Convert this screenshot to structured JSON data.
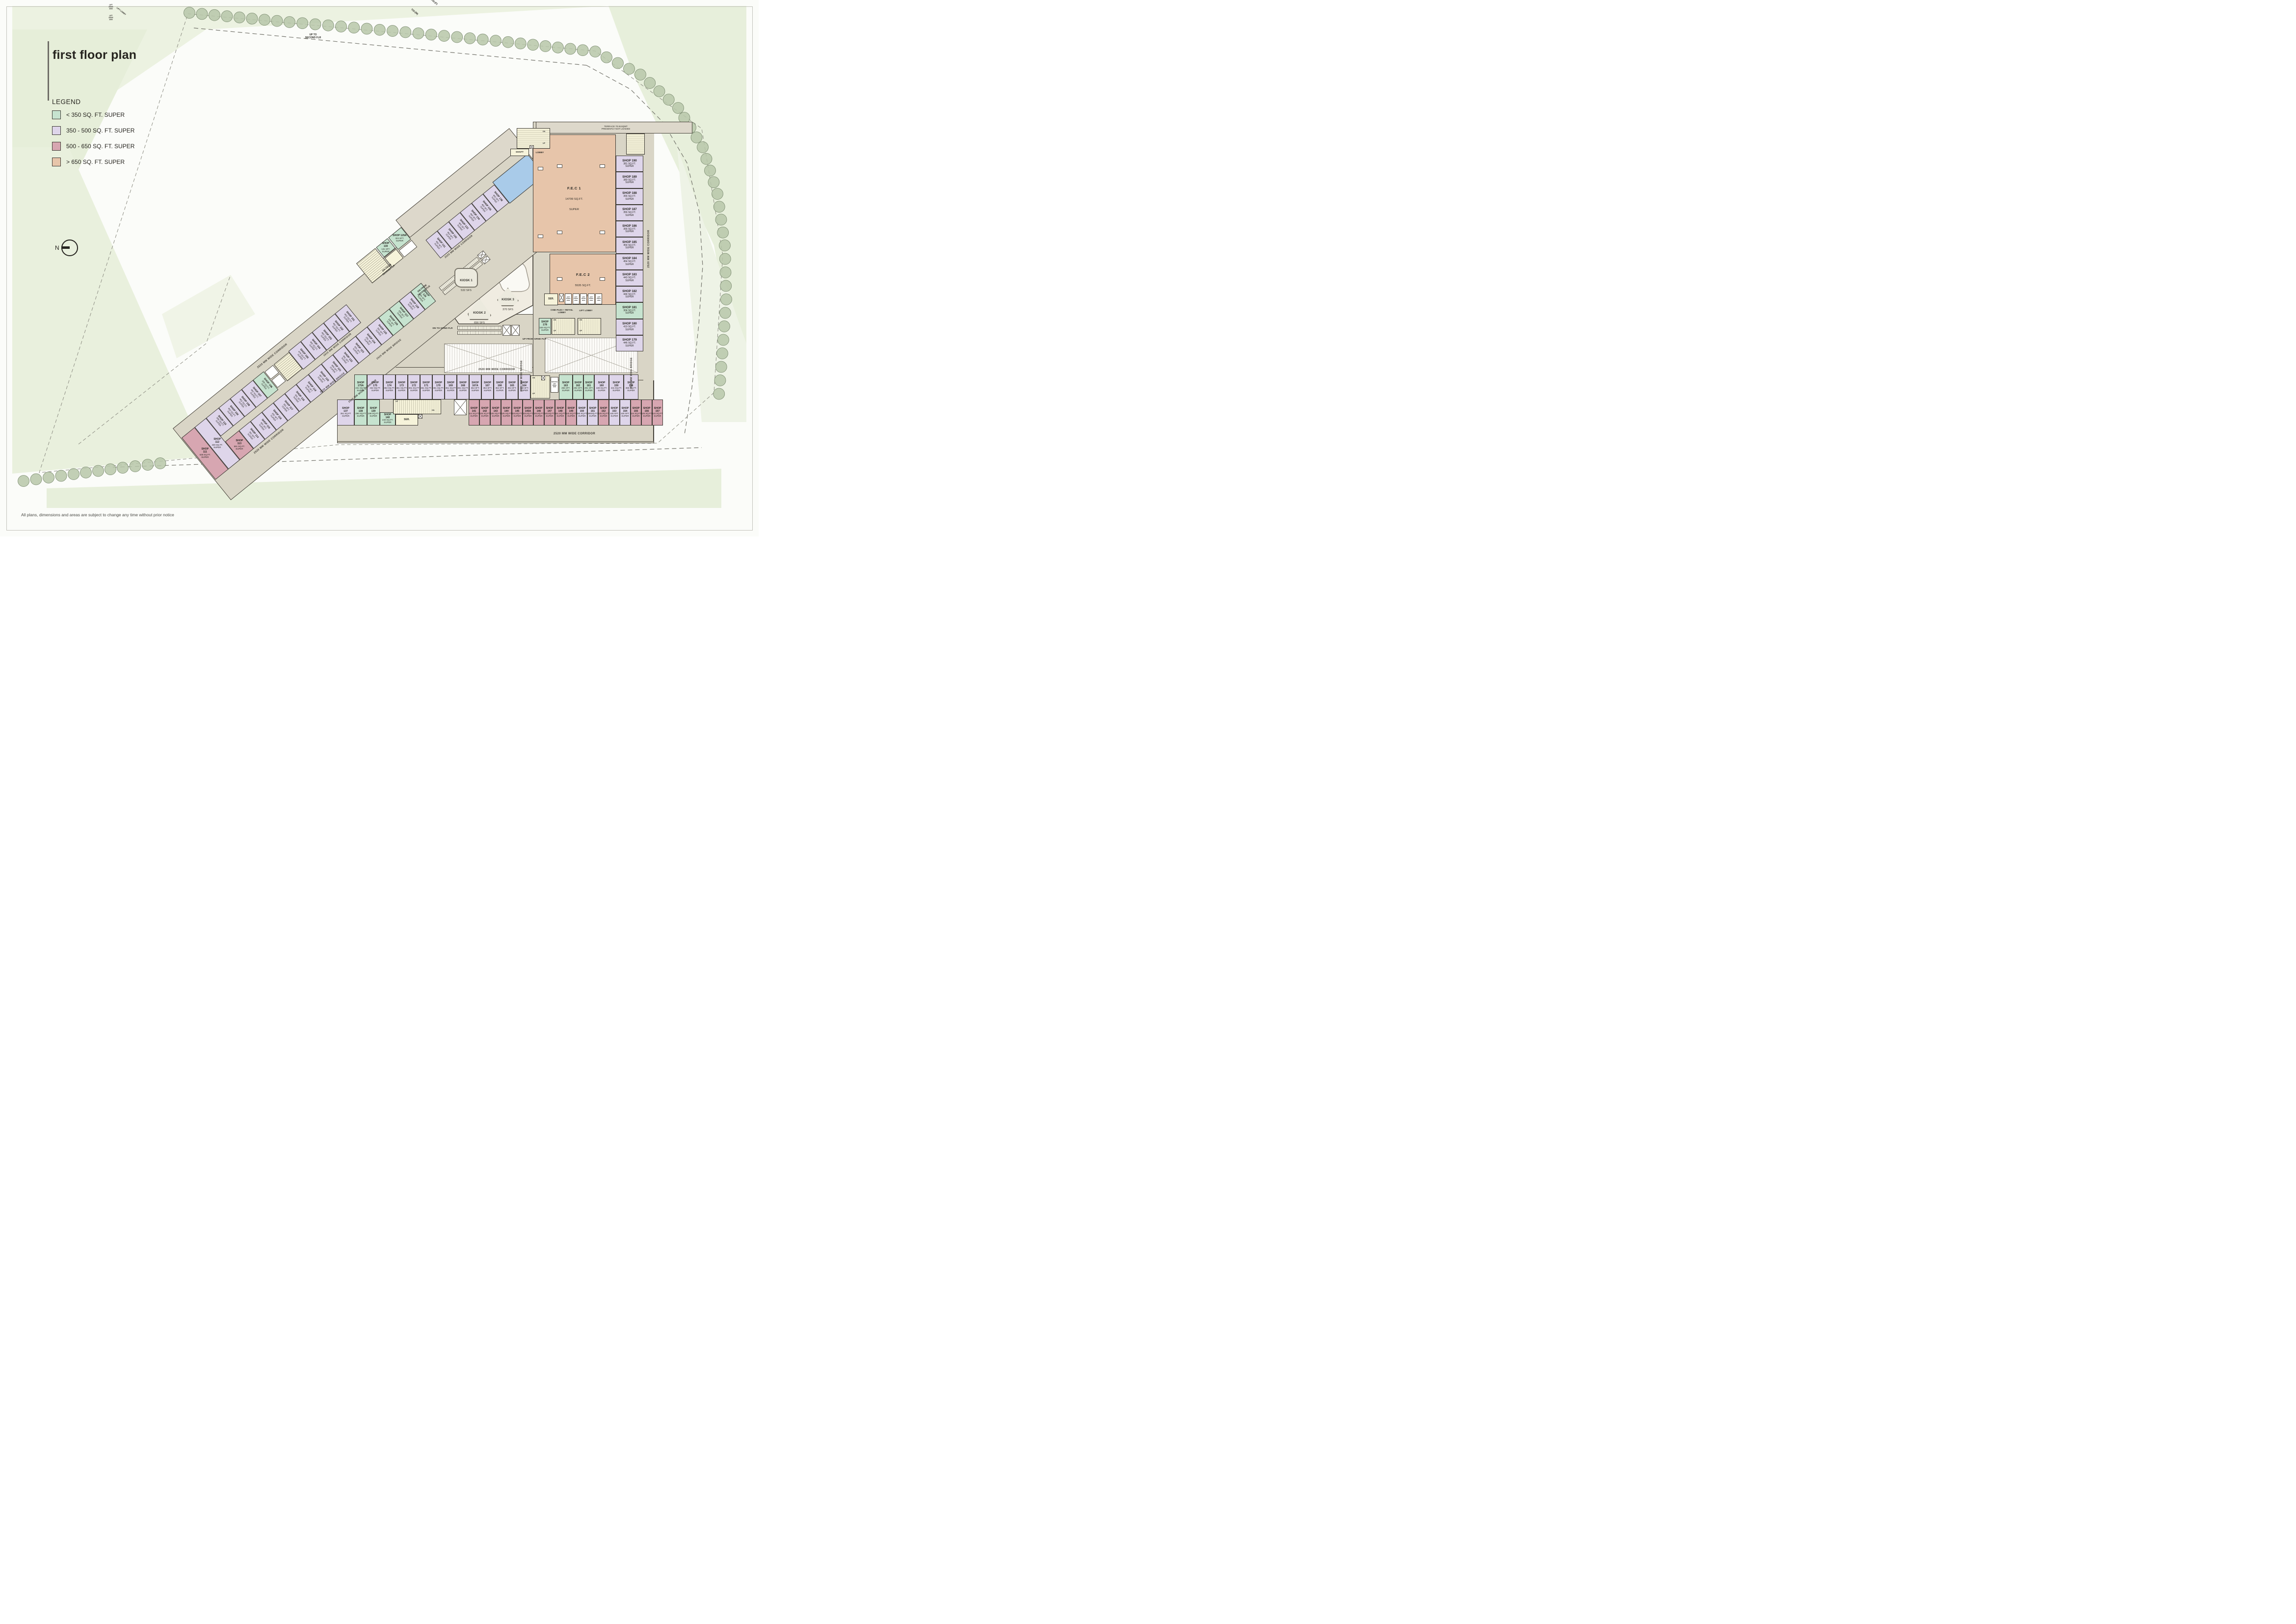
{
  "title": "first floor plan",
  "legend": {
    "heading": "LEGEND",
    "items": [
      {
        "label": "< 350 SQ. FT. SUPER",
        "color": "#c6e3cf"
      },
      {
        "label": "350 - 500 SQ. FT. SUPER",
        "color": "#ded5ea"
      },
      {
        "label": "500 - 650 SQ. FT. SUPER",
        "color": "#d7a6b1"
      },
      {
        "label": "> 650 SQ. FT. SUPER",
        "color": "#e7c5aa"
      }
    ]
  },
  "north_label": "N",
  "disclaimer": "All plans, dimensions and areas are subject to change any time without prior notice",
  "labels": {
    "super": "SUPER",
    "corridor_2520": "2520 MM WIDE CORRIDOR",
    "corridor_1915": "1915 MM WIDE CORRIDOR",
    "bridge_2520": "2520 MM WIDE BRIDGE",
    "terrace_top": "TERRACE 70.91SQMT\nPRESENTLY NOT LOADED",
    "terrace_wing": "TERRACE  277.6 SQMT\nPRESENTLY NOT LOADED"
  },
  "areas": {
    "fec1": {
      "name": "F.E.C 1",
      "area": "14799 SQ.FT.",
      "super": "SUPER"
    },
    "fec2": {
      "name": "F.E.C 2",
      "area": "5535 SQ.FT.",
      "super": "SUPER"
    },
    "kiosks": [
      {
        "name": "KIOSK 1",
        "area": "532 SFS"
      },
      {
        "name": "KIOSK 2",
        "area": "656 SFS"
      },
      {
        "name": "KIOSK 3",
        "area": "370 SFS"
      }
    ]
  },
  "rooms": {
    "toi_m": "TOI.(M)",
    "toi_f": "TOI.(F)",
    "shaft": "SHAFT",
    "lobby": "LOBBY",
    "ser": "SER.",
    "fhc": "FHC",
    "lift_lobby": "LIFT LOBBY",
    "cineplex": "CINE-PLEX + RETAIL\nLOBBY",
    "service_lift": "SERVICE LIFT\n3000X\n1800",
    "lift_2500": "LIFT\n2500X\n2000",
    "lift_2000": "LIFT\n2000X\n2500",
    "lift_3000": "LIFT\n3000X1800"
  },
  "circulation": {
    "up": "UP",
    "dn": "DN",
    "up_to_second": "UP TO\nSECOND FLR",
    "dn_from_second": "DN FROM\nSECOND FLR",
    "dn_to_grnd": "DN TO GRND FLR",
    "up_from_grnd": "UP FROM GRND  FLR"
  },
  "shops": {
    "wing_nw": [
      {
        "id": "SHOP  110",
        "area": "480 SQ.FT."
      },
      {
        "id": "SHOP  109",
        "area": "462 SQ.FT."
      },
      {
        "id": "SHOP  108",
        "area": "462 SQ.FT."
      },
      {
        "id": "SHOP  107",
        "area": "462 SQ.FT."
      },
      {
        "id": "SHOP  106",
        "area": "286 SQ.FT."
      },
      {
        "id": "SHOP  105",
        "area": "478 SQ.FT."
      },
      {
        "id": "SHOP  104",
        "area": "462 SQ.FT."
      },
      {
        "id": "SHOP  103",
        "area": "462 SQ.FT."
      },
      {
        "id": "SHOP  102",
        "area": "462 SQ.FT."
      },
      {
        "id": "SHOP  101",
        "area": "462 SQ.FT."
      }
    ],
    "wing_tip": [
      {
        "id": "SHOP\n111",
        "area": "638 SQ.FT."
      },
      {
        "id": "SHOP\n112",
        "area": "430 SQ.FT."
      },
      {
        "id": "SHOP\n113",
        "area": "591 SQ.FT."
      }
    ],
    "wing_se": [
      {
        "id": "SHOP  114",
        "area": "391 SFT."
      },
      {
        "id": "SHOP  115",
        "area": "391 SFT."
      },
      {
        "id": "SHOP  116",
        "area": "391 SFT."
      },
      {
        "id": "SHOP  117",
        "area": "391 SFT."
      },
      {
        "id": "SHOP  118",
        "area": "391 SFT."
      },
      {
        "id": "SHOP  119",
        "area": "445 SFT."
      },
      {
        "id": "SHOP  120",
        "area": "487 SFT."
      },
      {
        "id": "SHOP  121",
        "area": "404 SFT."
      },
      {
        "id": "SHOP  122",
        "area": "391 SFT."
      },
      {
        "id": "SHOP  123",
        "area": "391 SFT."
      },
      {
        "id": "SHOP  124",
        "area": "391 SFT."
      },
      {
        "id": "SHOP  125",
        "area": "391 SFT."
      },
      {
        "id": "SHOP  126",
        "area": "331 SFT."
      },
      {
        "id": "SHOP 127",
        "area": "284 SFT."
      },
      {
        "id": "SHOP 128",
        "area": "430 SFT."
      },
      {
        "id": "SHOP\n129",
        "area": "304 SFT."
      }
    ],
    "wing_top": [
      {
        "id": "SHOP  131",
        "area": "462 SFT."
      },
      {
        "id": "SHOP  132",
        "area": "462 SFT."
      },
      {
        "id": "SHOP  133",
        "area": "462 SFT."
      },
      {
        "id": "SHOP  134",
        "area": "462 SFT."
      },
      {
        "id": "SHOP  135",
        "area": "462 SFT."
      },
      {
        "id": "SHOP  136",
        "area": "462 SFT."
      }
    ],
    "wing_aux": [
      {
        "id": "SHOP\n130",
        "area": "131 SFT."
      },
      {
        "id": "SHOP 129A",
        "area": "324 SFT."
      }
    ],
    "right_col": [
      {
        "id": "SHOP  190",
        "area": "381 SQ.FT."
      },
      {
        "id": "SHOP  189",
        "area": "380 SQ.FT."
      },
      {
        "id": "SHOP  188",
        "area": "356 SQ.FT."
      },
      {
        "id": "SHOP  187",
        "area": "356 SQ.FT."
      },
      {
        "id": "SHOP  186",
        "area": "356 SQ.FT."
      },
      {
        "id": "SHOP  185",
        "area": "454 SQ.FT."
      },
      {
        "id": "SHOP  184",
        "area": "454 SQ.FT."
      },
      {
        "id": "SHOP 183",
        "area": "443 SQ.FT."
      },
      {
        "id": "SHOP 182",
        "area": "444 SQ.FT."
      },
      {
        "id": "SHOP 181",
        "area": "304 SQ.FT."
      },
      {
        "id": "SHOP 180",
        "area": "419 SQ.FT."
      },
      {
        "id": "SHOP 179",
        "area": "446 SQ.FT."
      }
    ],
    "right_mid": [
      {
        "id": "SHOP  178",
        "area": "349 SQ.FT."
      }
    ],
    "bottom_top": [
      {
        "id": "SHOP\n174",
        "area": "353 SQ.FT."
      },
      {
        "id": "SHOP\n173",
        "area": "361 SQ.FT."
      },
      {
        "id": "SHOP\n172",
        "area": "361 SQ.FT"
      },
      {
        "id": "SHOP\n171",
        "area": "361 SQ.FT."
      },
      {
        "id": "SHOP\n170",
        "area": "361 SQ.FT."
      },
      {
        "id": "SHOP\n169",
        "area": "361 SQ.FT"
      },
      {
        "id": "SHOP\n168",
        "area": "361 SQ.FT."
      },
      {
        "id": "SHOP\n167A",
        "area": "364 SFT."
      },
      {
        "id": "SHOP\n167",
        "area": "364 SFT."
      },
      {
        "id": "SHOP\n166",
        "area": "364 SFT."
      },
      {
        "id": "SHOP\n165",
        "area": "364 SFT."
      },
      {
        "id": "SHOP\n164",
        "area": "380 SFT."
      }
    ],
    "bottom_top_right": [
      {
        "id": "SHOP\n163",
        "area": "255 SFT."
      },
      {
        "id": "SHOP\n162",
        "area": "292 SFT."
      },
      {
        "id": "SHOP\n161",
        "area": "291 SFT."
      },
      {
        "id": "SHOP\n160",
        "area": "428 SQ.FT."
      },
      {
        "id": "SHOP\n159",
        "area": "431 SQ.FT."
      },
      {
        "id": "SHOP\n158",
        "area": "360 SQ.FT."
      }
    ],
    "bottom_bot_left": [
      {
        "id": "SHOP\n137",
        "area": "351 SQ.FT"
      },
      {
        "id": "SHOP\n138",
        "area": "299 SQ.FT"
      },
      {
        "id": "SHOP\n139",
        "area": "299 SQ.FT."
      },
      {
        "id": "SHOP\n140",
        "area": "240 SQ.FT."
      }
    ],
    "bottom_mid": [
      {
        "id": "SHOP\n175A",
        "area": "231 SQ.FT"
      },
      {
        "id": "SHOP\n175",
        "area": "432 SQ.FT."
      }
    ],
    "bottom_bot_right": [
      {
        "id": "SHOP\n141",
        "area": "614 SQ.FT."
      },
      {
        "id": "SHOP\n142",
        "area": "525 SQ.FT."
      },
      {
        "id": "SHOP\n143",
        "area": "525 SQ.FT"
      },
      {
        "id": "SHOP\n144",
        "area": "525 SQ.FT"
      },
      {
        "id": "SHOP\n145",
        "area": "531SQ.FT."
      },
      {
        "id": "SHOP\n145A",
        "area": "531SQ.FT."
      },
      {
        "id": "SHOP\n146",
        "area": "531SQ.FT."
      },
      {
        "id": "SHOP\n147",
        "area": "531SQ.FT."
      },
      {
        "id": "SHOP\n148",
        "area": "551 SQ.FT."
      },
      {
        "id": "SHOP\n149",
        "area": "543 SQ.FT."
      },
      {
        "id": "SHOP\n150",
        "area": "490 SQ.FT."
      },
      {
        "id": "SHOP\n151",
        "area": "490SQ.FT."
      },
      {
        "id": "SHOP\n152",
        "area": "525 SQ.FT."
      },
      {
        "id": "SHOP\n153",
        "area": "425 SFT."
      },
      {
        "id": "SHOP\n154",
        "area": "425 SFT."
      },
      {
        "id": "SHOP\n155",
        "area": "624 SQ.FT."
      },
      {
        "id": "SHOP\n156",
        "area": "626 SQ.FT."
      },
      {
        "id": "SHOP\n157",
        "area": "524 SQ.FT."
      }
    ]
  }
}
